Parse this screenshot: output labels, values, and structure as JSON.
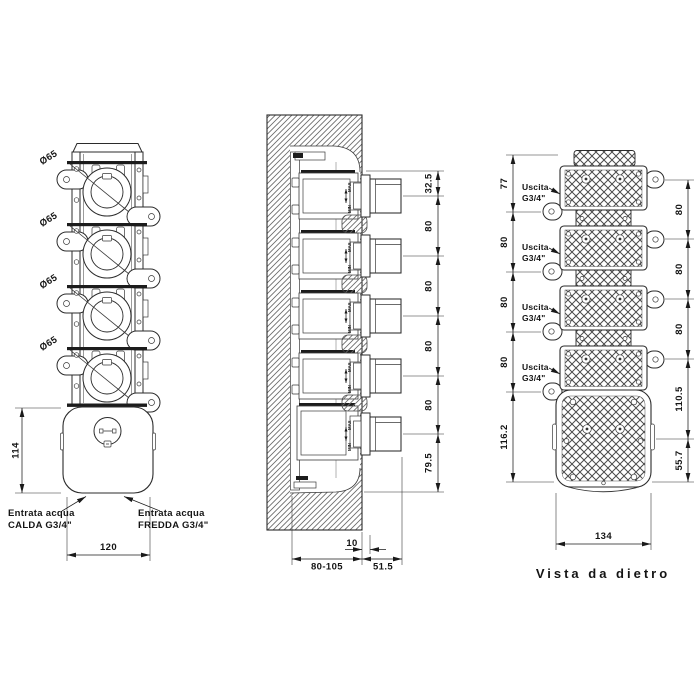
{
  "front": {
    "dia": [
      "Ø65",
      "Ø65",
      "Ø65",
      "Ø65"
    ],
    "dim_height": "114",
    "dim_width": "120",
    "inlet_hot": {
      "line1": "Entrata acqua",
      "line2": "CALDA G3/4\""
    },
    "inlet_cold": {
      "line1": "Entrata acqua",
      "line2": "FREDDA G3/4\""
    }
  },
  "section": {
    "dims_vertical": [
      "32.5",
      "80",
      "80",
      "80",
      "80",
      "79.5"
    ],
    "dim_plate": "10",
    "dim_depth": "80-105",
    "dim_protrusion": "51.5",
    "adjust_max": "MAX",
    "adjust_min": "MIN"
  },
  "rear": {
    "outlets": [
      {
        "line1": "Uscita",
        "line2": "G3/4\""
      },
      {
        "line1": "Uscita",
        "line2": "G3/4\""
      },
      {
        "line1": "Uscita",
        "line2": "G3/4\""
      },
      {
        "line1": "Uscita",
        "line2": "G3/4\""
      }
    ],
    "dims_left": [
      "77",
      "80",
      "80",
      "80",
      "116.2"
    ],
    "dims_right": [
      "80",
      "80",
      "80",
      "110.5",
      "55.7"
    ],
    "dim_width": "134",
    "caption": "Vista da dietro"
  },
  "colors": {
    "line": "#2b2b2b",
    "background": "#ffffff"
  }
}
